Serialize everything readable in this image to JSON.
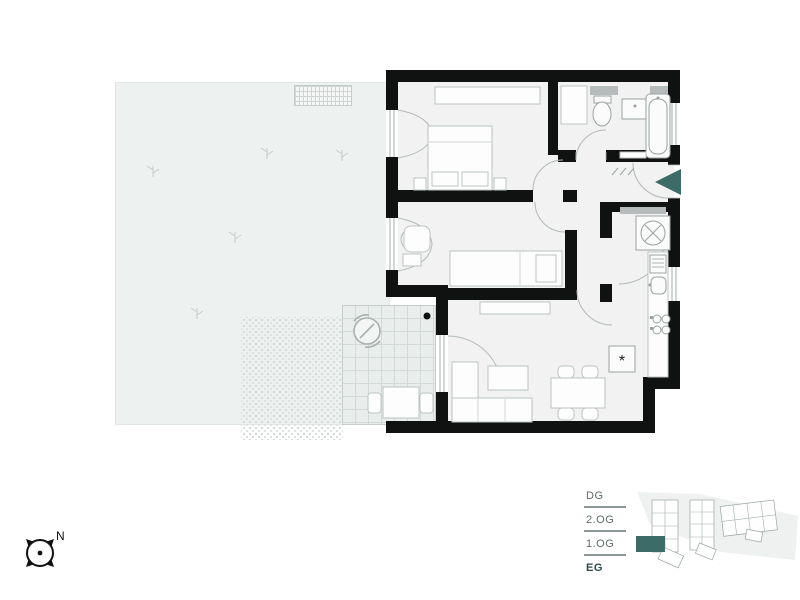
{
  "title": "apartment-floorplan-eg",
  "colors": {
    "accent_teal": "#3d6b68",
    "active_floor_text": "#2b4a49",
    "wall_black": "#101212",
    "garden_fill": "#edf1ef",
    "terrace_fill": "#e9edec",
    "site_wedge_fill": "#eff1f0"
  },
  "compass": {
    "north_label": "N"
  },
  "floor_selector": {
    "items": [
      {
        "label": "DG",
        "active": false
      },
      {
        "label": "2.OG",
        "active": false
      },
      {
        "label": "1.OG",
        "active": false
      },
      {
        "label": "EG",
        "active": true
      }
    ]
  },
  "plan": {
    "fridge_symbol": "*",
    "icons": {
      "entrance_marker": "teal-triangle-left",
      "washing_machine": "circle-with-cross",
      "cooktop": "four-burner-circles",
      "parasol": "circle-with-arrows",
      "compass": "circle-with-four-points"
    }
  },
  "site_map": {
    "highlighted_unit_floor": "EG"
  }
}
